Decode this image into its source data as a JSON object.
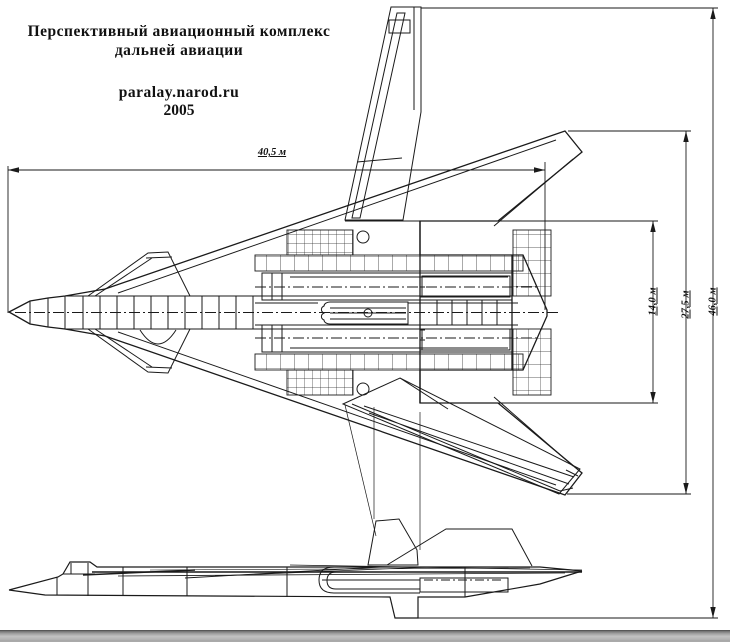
{
  "title": {
    "line1": "Перспективный авиационный комплекс",
    "line2": "дальней авиации",
    "site": "paralay.narod.ru",
    "year": "2005"
  },
  "dimensions": {
    "length": "40,5 м",
    "inner_span": "14,0 м",
    "wing_span": "27,5 м",
    "full_span": "46,0 м"
  },
  "colors": {
    "line": "#1a1a1a",
    "background": "#ffffff",
    "bar_dark": "#6e6e6e",
    "bar_light": "#d2d2d2"
  }
}
